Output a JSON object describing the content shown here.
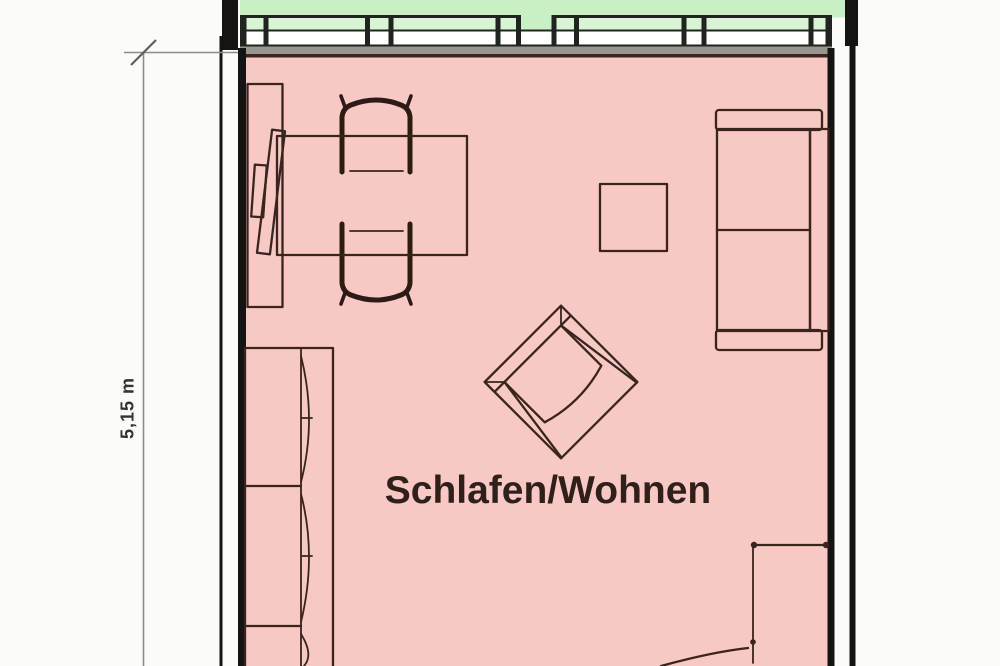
{
  "labels": {
    "room": "Schlafen/Wohnen",
    "dimension": "5,15 m"
  },
  "colors": {
    "page_bg": "#fbfbf9",
    "room_fill": "#f8c8c4",
    "balcony_fill": "#c9efc4",
    "glass_band_fill": "#d9f4d4",
    "sill_gray": "#98968e",
    "wall_dark": "#161412",
    "frame_dark": "#20241e",
    "line_brown": "#3a2620",
    "furniture_line": "#3a241e",
    "chair_line": "#2d1b16",
    "dim_line": "#8c8c8c",
    "text_color": "#30201b"
  },
  "icons": {
    "sofa_left": "sofa-outline",
    "sofa_right": "sofa-outline",
    "armchair": "armchair-rotated-45",
    "dining_table": "rectangle-table",
    "square_table": "square-table",
    "chairs": "armchair-top-view",
    "sideboard": "sideboard-with-tv",
    "door": "door-swing-arc"
  }
}
